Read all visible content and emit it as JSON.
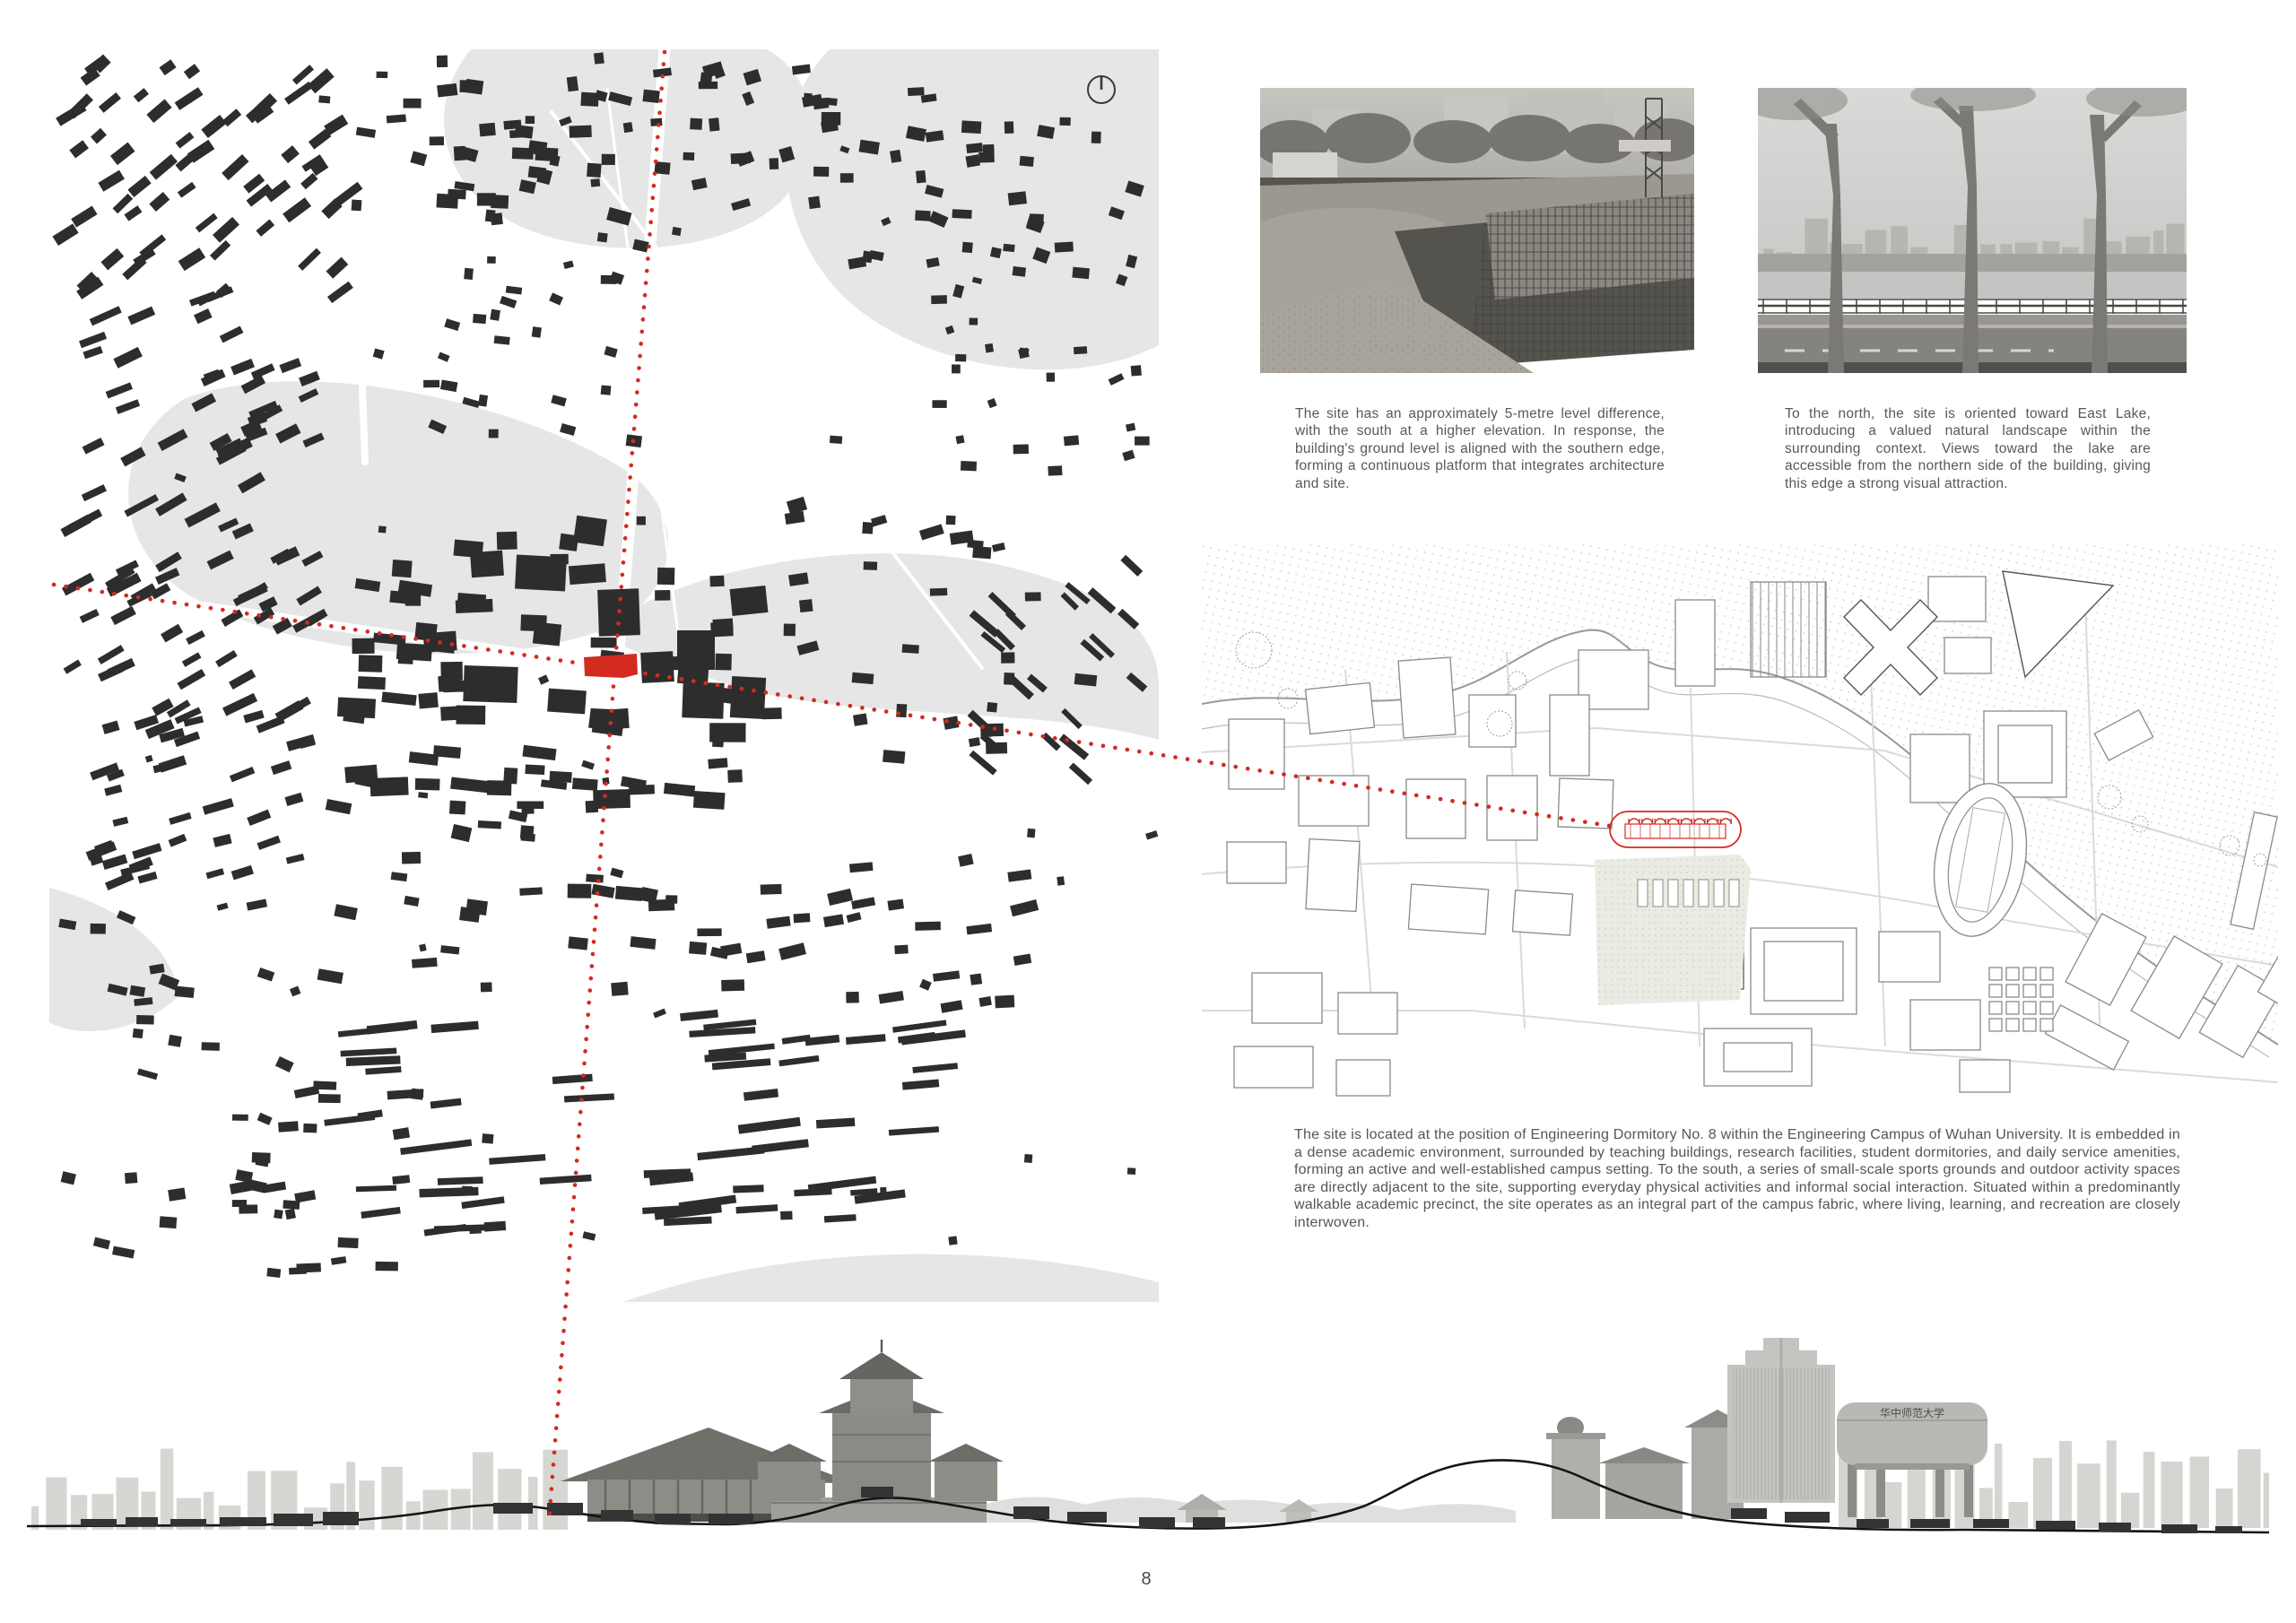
{
  "page": {
    "number": "8"
  },
  "colors": {
    "accent_red": "#d32b20",
    "building_black": "#2d2d2d",
    "map_gray": "#e6e6e6",
    "plan_line": "#8a8a8a",
    "text_gray": "#58585a"
  },
  "icons": {
    "north_arrow": "compass-north-icon"
  },
  "figures": {
    "photo1": {
      "caption": "The site has an approximately 5-metre level difference, with the south at a higher elevation. In response, the building's ground level is aligned with the southern edge, forming a continuous platform that integrates architecture and site."
    },
    "photo2": {
      "caption": "To the north, the site is oriented toward East Lake, introducing a valued natural landscape within the surrounding context. Views toward the lake are accessible from the northern side of the building, giving this edge a strong visual attraction."
    }
  },
  "site_text": "The site is located at the position of Engineering Dormitory No. 8 within the Engineering Campus of Wuhan University. It is embedded in a dense academic environment, surrounded by teaching buildings, research facilities, student dormitories, and daily service amenities, forming an active and well-established campus setting. To the south, a series of small-scale sports grounds and outdoor activity spaces are directly adjacent to the site, supporting everyday physical activities and informal social interaction. Situated within a predominantly walkable academic precinct, the site operates as an integral part of the campus fabric, where living, learning, and recreation are closely interwoven.",
  "panorama": {
    "gate_calligraphy": "华中师范大学"
  }
}
